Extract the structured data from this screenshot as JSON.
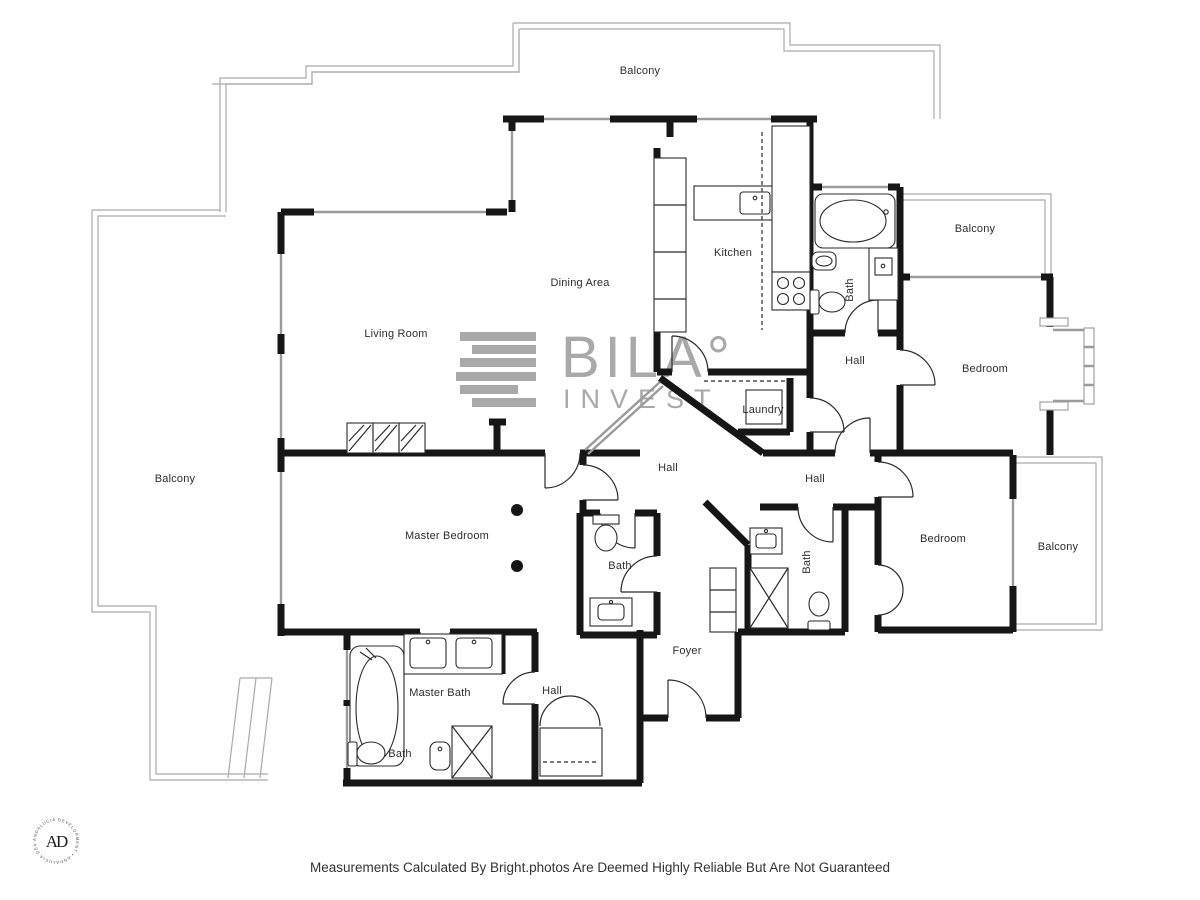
{
  "rooms": [
    "Balcony",
    "Balcony",
    "Kitchen",
    "Dining Area",
    "Living Room",
    "Bath",
    "Hall",
    "Bedroom",
    "Laundry",
    "Hall",
    "Hall",
    "Balcony",
    "Master Bedroom",
    "Bedroom",
    "Balcony",
    "Bath",
    "Bath",
    "Foyer",
    "Master Bath",
    "Hall",
    "Bath"
  ],
  "watermark": {
    "brand": "BILA°",
    "name": "INVEST"
  },
  "badge": {
    "monogram": "AD",
    "ring": "ANDALUCIA DEVELOPMENT • ANDALUCIA DEVELOPMENT •"
  },
  "footer": {
    "disclaimer": "Measurements Calculated By Bright.photos Are Deemed Highly Reliable But Are Not Guaranteed"
  },
  "colors": {
    "wall": "#161616",
    "window": "#9b9b9b",
    "balcony": "#ababab",
    "watermark": "#a9a9a9",
    "text": "#2e2e2e"
  }
}
